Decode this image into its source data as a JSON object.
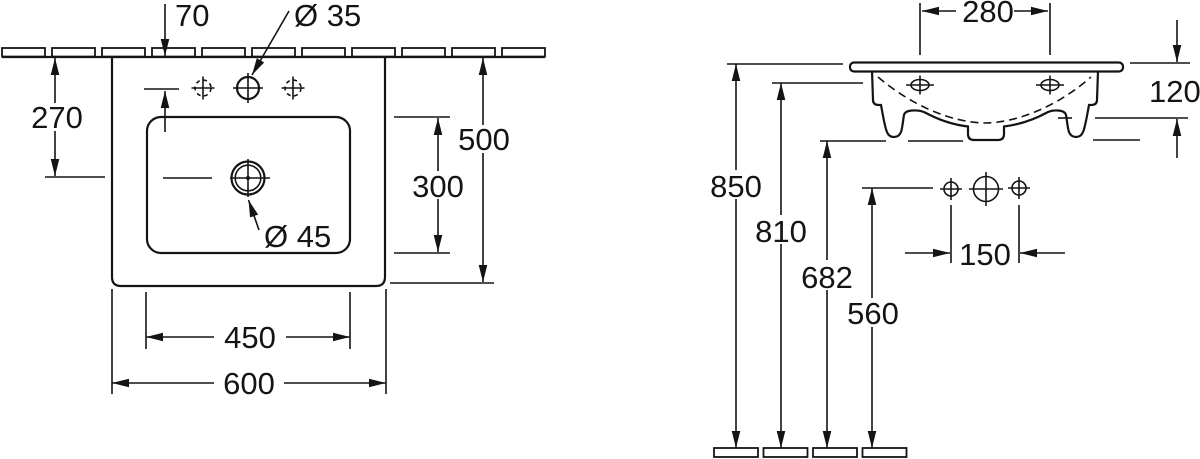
{
  "drawing": {
    "background": "#ffffff",
    "line_color": "#141414",
    "subject": "Wall-mounted washbasin technical drawing, top view and side view, dimensions in mm"
  },
  "top_view": {
    "dims": {
      "offset_70": "70",
      "dia_35": "Ø 35",
      "offset_270": "270",
      "depth_500": "500",
      "bowl_300": "300",
      "dia_45": "Ø 45",
      "bowl_450": "450",
      "width_600": "600"
    }
  },
  "side_view": {
    "dims": {
      "holes_280": "280",
      "height_120": "120",
      "height_850": "850",
      "height_810": "810",
      "height_682": "682",
      "height_560": "560",
      "holes_150": "150"
    }
  }
}
